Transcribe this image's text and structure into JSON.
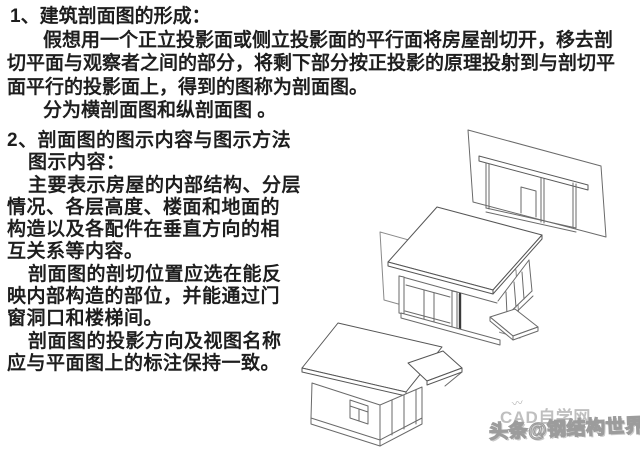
{
  "page": {
    "background": "#ffffff",
    "text_color": "#1e1e1e"
  },
  "section1": {
    "heading": "1、建筑剖面图的形成：",
    "lines": [
      "假想用一个正立投影面或侧立投影面的平行面将房屋剖切开，移去剖",
      "切平面与观察者之间的部分，将剩下部分按正投影的原理投射到与剖切平",
      "面平行的投影面上，得到的图称为剖面图。",
      "分为横剖面图和纵剖面图 。"
    ]
  },
  "section2": {
    "heading": "2、剖面图的图示内容与图示方法",
    "subheading": "图示内容：",
    "lines": [
      "主要表示房屋的内部结构、分层",
      "情况、各层高度、楼面和地面的",
      "构造以及各配件在垂直方向的相",
      "互关系等内容。",
      "剖面图的剖切位置应选在能反",
      "映内部构造的部位，并能通过门",
      "窗洞口和楼梯间。",
      "剖面图的投影方向及视图名称",
      "应与平面图上的标注保持一致。"
    ]
  },
  "diagram": {
    "type": "axonometric-line-drawing",
    "parts": {
      "projection_plane": "projection-plane-with-section-view",
      "cutting_plane": "transparent-cutting-plane",
      "sectioned_house": "remaining-rear-part-of-house",
      "removed_part": "removed-front-part-of-house"
    },
    "line_color": "#6a6a6a"
  },
  "watermarks": {
    "cad_site": "CAD自学网",
    "toutiao": "头条@钢结构世界",
    "logo_mark": "〰"
  }
}
